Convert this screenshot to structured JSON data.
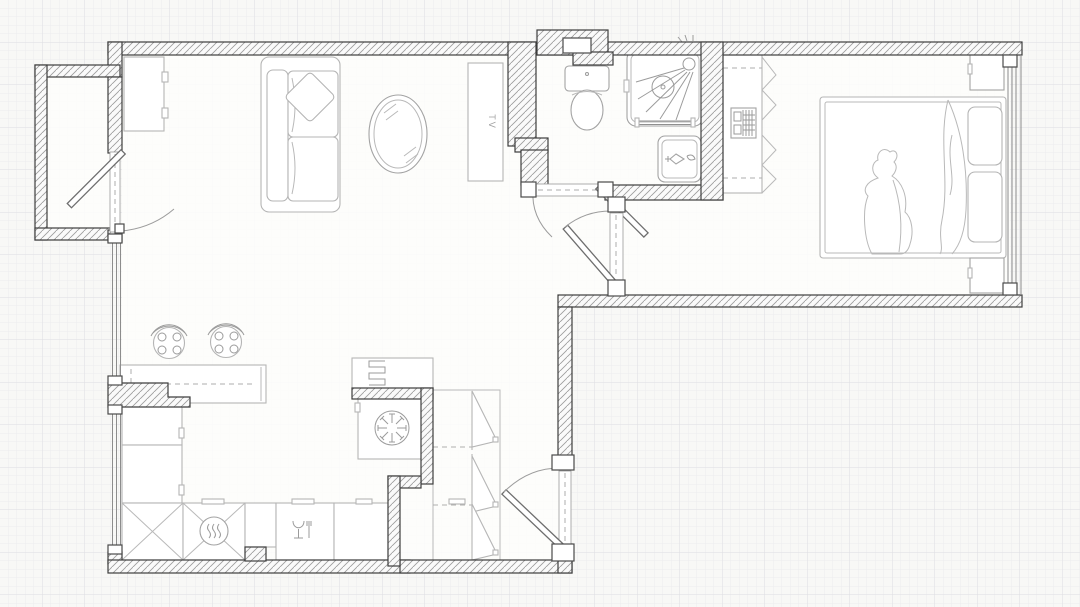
{
  "title": "Apartment floor plan",
  "labels": {
    "tv": "TV"
  },
  "colors": {
    "background": "#f7f7f5",
    "grid_minor": "#ececee",
    "grid_major": "#dddde1",
    "interior_fill": "#fdfdfc",
    "wall_outline": "#3d3d3d",
    "wall_hatch": "#9c9c9c",
    "furniture_line": "#b5b5b5",
    "fixture_line": "#a3a3a3",
    "door_leaf": "#6e6e6e",
    "window_line": "#8c8c8c",
    "label_text": "#9e9e9e"
  },
  "rooms": [
    "living-room",
    "kitchen",
    "hallway",
    "bathroom",
    "bedroom",
    "closet-nook",
    "balcony"
  ],
  "furniture_and_fixtures": [
    "tall-cabinet",
    "sofa",
    "throw-pillow",
    "coffee-table",
    "tv-stand",
    "entry-door",
    "left-window",
    "kitchen-island",
    "bar-stool",
    "bar-stool",
    "radiator",
    "fan-appliance",
    "kitchen-cabinets",
    "corner-cabinet",
    "stove",
    "dishwasher",
    "counter",
    "closet-shelves",
    "closet-door",
    "bathroom-door",
    "toilet",
    "shower",
    "wash-basin",
    "ventilation-shaft",
    "bedroom-door",
    "wardrobe",
    "drawer-unit",
    "double-bed",
    "duvet",
    "blanket-fold",
    "pillow",
    "pillow",
    "nightstand",
    "nightstand",
    "bedroom-window"
  ]
}
